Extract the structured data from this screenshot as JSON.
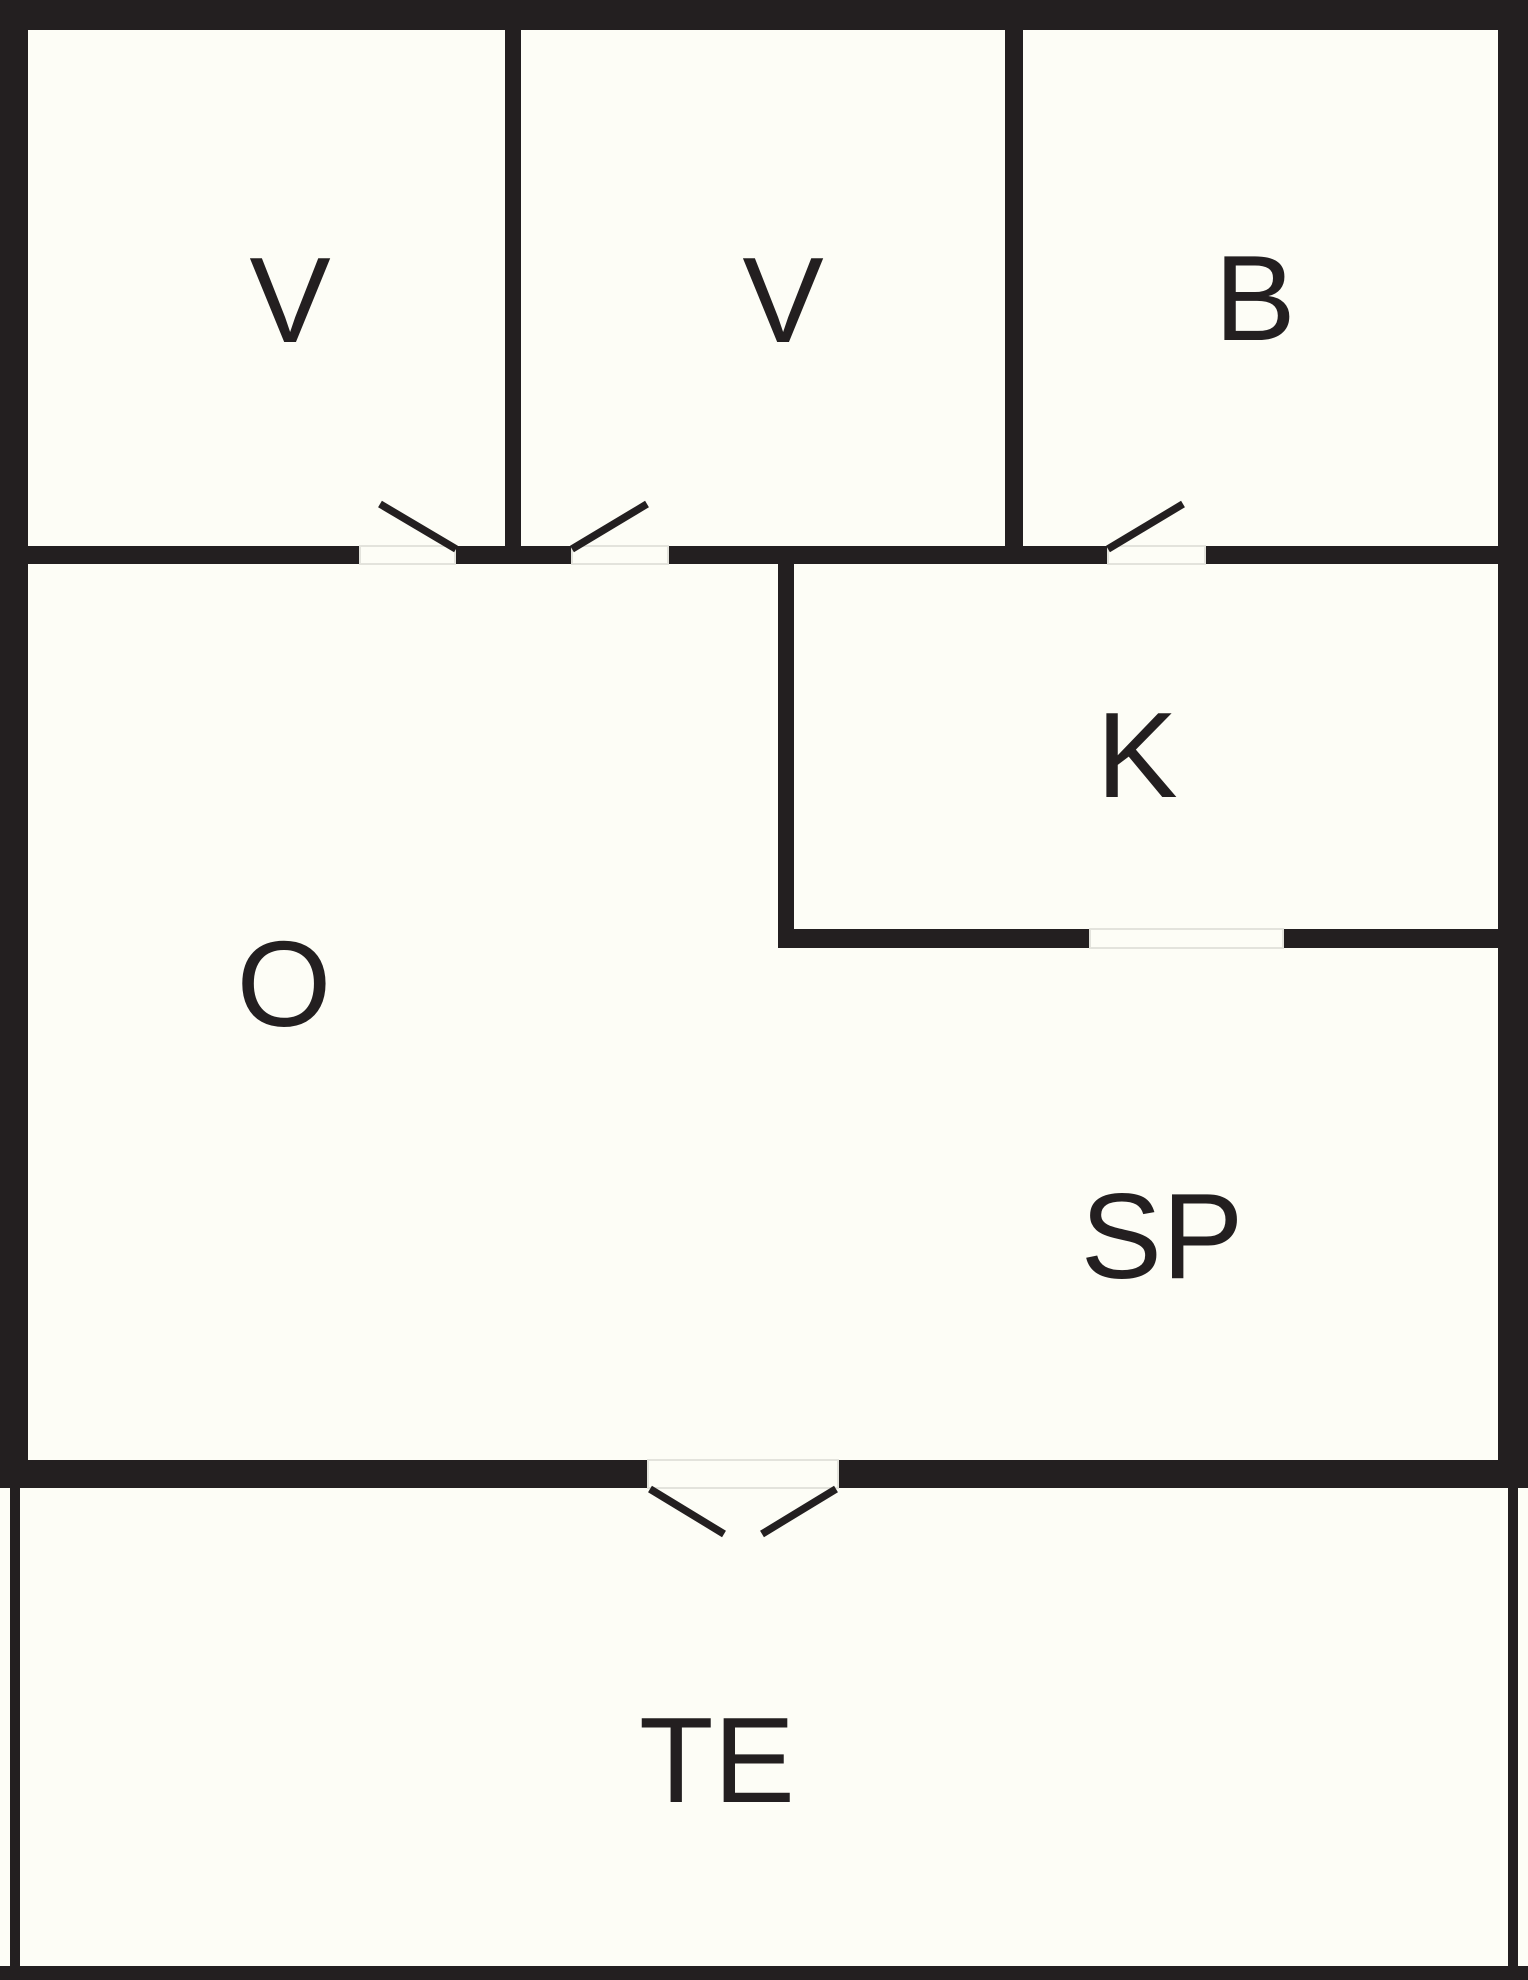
{
  "title": "floor-plan",
  "canvas": {
    "width": 1528,
    "height": 1980,
    "background": "#fdfdf6",
    "wall_color": "#231f20",
    "label_color": "#231f20",
    "label_font_size": 122,
    "door_jamb_color": "#e3e3dc",
    "door_line_width": 7.5
  },
  "rooms": [
    {
      "id": "bedroom-1",
      "label": "V",
      "cx": 290,
      "cy": 300
    },
    {
      "id": "bedroom-2",
      "label": "V",
      "cx": 783,
      "cy": 300
    },
    {
      "id": "bathroom",
      "label": "B",
      "cx": 1255,
      "cy": 298
    },
    {
      "id": "kitchen",
      "label": "K",
      "cx": 1137,
      "cy": 755
    },
    {
      "id": "living-room",
      "label": "O",
      "cx": 284,
      "cy": 984
    },
    {
      "id": "dining-area",
      "label": "SP",
      "cx": 1162,
      "cy": 1236
    },
    {
      "id": "terrace",
      "label": "TE",
      "cx": 717,
      "cy": 1760
    }
  ],
  "walls": [
    {
      "id": "outer-top",
      "x": 0,
      "y": 0,
      "w": 1528,
      "h": 30
    },
    {
      "id": "outer-left",
      "x": 0,
      "y": 0,
      "w": 28,
      "h": 1488
    },
    {
      "id": "outer-right",
      "x": 1498,
      "y": 0,
      "w": 30,
      "h": 1488
    },
    {
      "id": "main-bottom-left",
      "x": 0,
      "y": 1460,
      "w": 648,
      "h": 28
    },
    {
      "id": "main-bottom-right",
      "x": 838,
      "y": 1460,
      "w": 690,
      "h": 28
    },
    {
      "id": "toprow-bottom-a",
      "x": 28,
      "y": 546,
      "w": 332,
      "h": 18
    },
    {
      "id": "toprow-bottom-b",
      "x": 455,
      "y": 546,
      "w": 117,
      "h": 18
    },
    {
      "id": "toprow-bottom-c",
      "x": 668,
      "y": 546,
      "w": 440,
      "h": 18
    },
    {
      "id": "toprow-bottom-d",
      "x": 1205,
      "y": 546,
      "w": 323,
      "h": 18
    },
    {
      "id": "divider-v1-v2",
      "x": 505,
      "y": 30,
      "w": 16,
      "h": 516
    },
    {
      "id": "divider-v2-b",
      "x": 1005,
      "y": 30,
      "w": 18,
      "h": 516
    },
    {
      "id": "kitchen-left",
      "x": 778,
      "y": 546,
      "w": 16,
      "h": 402
    },
    {
      "id": "kitchen-bottom-left",
      "x": 778,
      "y": 929,
      "w": 312,
      "h": 19
    },
    {
      "id": "kitchen-bottom-right",
      "x": 1283,
      "y": 929,
      "w": 245,
      "h": 19
    },
    {
      "id": "terrace-left",
      "x": 10,
      "y": 1488,
      "w": 10,
      "h": 492
    },
    {
      "id": "terrace-right",
      "x": 1508,
      "y": 1488,
      "w": 10,
      "h": 480
    },
    {
      "id": "terrace-bottom",
      "x": 0,
      "y": 1966,
      "w": 1528,
      "h": 14
    }
  ],
  "door_openings": [
    {
      "id": "door-opening-bedroom-1",
      "x": 360,
      "y": 546,
      "w": 95,
      "h": 18
    },
    {
      "id": "door-opening-bedroom-2",
      "x": 572,
      "y": 546,
      "w": 96,
      "h": 18
    },
    {
      "id": "door-opening-bathroom",
      "x": 1108,
      "y": 546,
      "w": 97,
      "h": 18
    },
    {
      "id": "door-opening-kitchen",
      "x": 1090,
      "y": 929,
      "w": 193,
      "h": 19
    },
    {
      "id": "door-opening-terrace",
      "x": 648,
      "y": 1460,
      "w": 190,
      "h": 28
    }
  ],
  "door_swings": [
    {
      "id": "door-swing-bedroom-1",
      "x1": 380,
      "y1": 504,
      "x2": 456,
      "y2": 549
    },
    {
      "id": "door-swing-bedroom-2",
      "x1": 572,
      "y1": 549,
      "x2": 647,
      "y2": 504
    },
    {
      "id": "door-swing-bathroom",
      "x1": 1108,
      "y1": 549,
      "x2": 1183,
      "y2": 504
    },
    {
      "id": "door-swing-terrace-left",
      "x1": 650,
      "y1": 1489,
      "x2": 724,
      "y2": 1534
    },
    {
      "id": "door-swing-terrace-right",
      "x1": 836,
      "y1": 1489,
      "x2": 762,
      "y2": 1534
    }
  ]
}
